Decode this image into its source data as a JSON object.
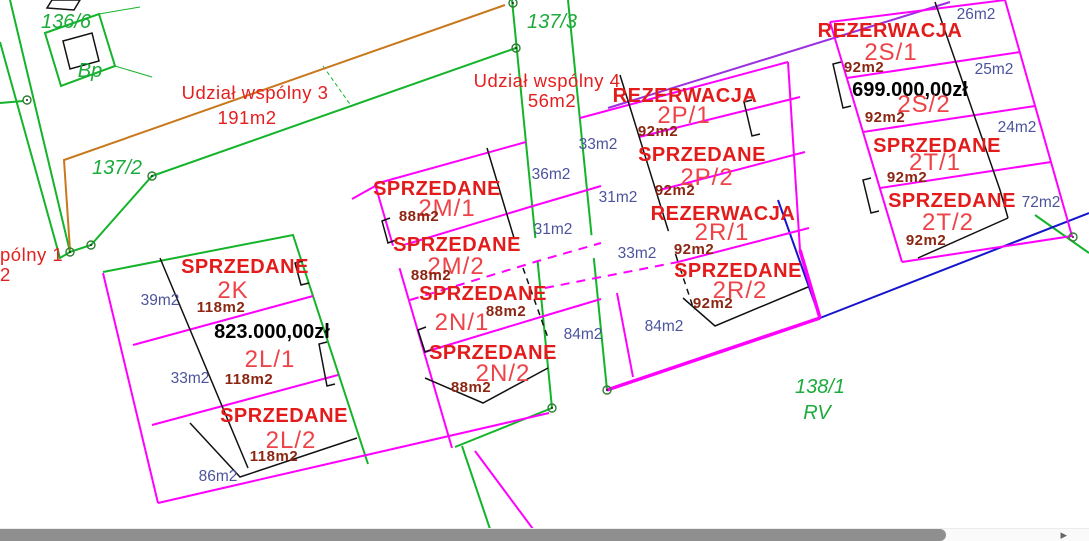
{
  "colors": {
    "boundary_green": "#14b42a",
    "division_magenta": "#ff00ff",
    "common_purple": "#9b30e0",
    "road_orange": "#c8791e",
    "boundary_blue": "#1515cc",
    "status_red": "#e31b1b",
    "unit_red": "#ee4348",
    "area_maroon": "#8b2612",
    "yard_blue": "#4b549c",
    "price_black": "#000000",
    "scrollbar_gray": "#8f8f8f"
  },
  "parcels": {
    "p136_6": "136/6",
    "bp": "Bp",
    "p137_3": "137/3",
    "p137_2": "137/2",
    "p138_1": "138/1",
    "rv": "RV"
  },
  "common_areas": {
    "c3": {
      "name": "Udział wspólny 3",
      "area": "191m2"
    },
    "c4": {
      "name": "Udział wspólny 4",
      "area": "56m2"
    },
    "c1": {
      "name": "pólny 1",
      "area": "2"
    }
  },
  "units": {
    "u2k": {
      "status": "SPRZEDANE",
      "id": "2K",
      "area": "118m2"
    },
    "u2l1": {
      "price": "823.000,00zł",
      "id": "2L/1",
      "area": "118m2"
    },
    "u2l2": {
      "status": "SPRZEDANE",
      "id": "2L/2",
      "area": "118m2"
    },
    "u2m1": {
      "status": "SPRZEDANE",
      "id": "2M/1",
      "area": "88m2"
    },
    "u2m2": {
      "status": "SPRZEDANE",
      "id": "2M/2",
      "area": "88m2"
    },
    "u2n1": {
      "status": "SPRZEDANE",
      "id": "2N/1",
      "area": "88m2"
    },
    "u2n2": {
      "status": "SPRZEDANE",
      "id": "2N/2",
      "area": "88m2"
    },
    "u2p1": {
      "status": "REZERWACJA",
      "id": "2P/1",
      "area": "92m2"
    },
    "u2p2": {
      "status": "SPRZEDANE",
      "id": "2P/2",
      "area": "92m2"
    },
    "u2r1": {
      "status": "REZERWACJA",
      "id": "2R/1",
      "area": "92m2"
    },
    "u2r2": {
      "status": "SPRZEDANE",
      "id": "2R/2",
      "area": "92m2"
    },
    "u2s1": {
      "status": "REZERWACJA",
      "id": "2S/1",
      "area": "92m2"
    },
    "u2s2": {
      "price": "699.000,00zł",
      "id": "2S/2",
      "area": "92m2"
    },
    "u2t1": {
      "status": "SPRZEDANE",
      "id": "2T/1",
      "area": "92m2"
    },
    "u2t2": {
      "status": "SPRZEDANE",
      "id": "2T/2",
      "area": "92m2"
    }
  },
  "yard_areas": [
    "39m2",
    "33m2",
    "86m2",
    "36m2",
    "31m2",
    "31m2",
    "33m2",
    "33m2",
    "84m2",
    "84m2",
    "26m2",
    "25m2",
    "24m2",
    "72m2"
  ],
  "icons": {
    "scrollbar_right_arrow": "▸"
  }
}
